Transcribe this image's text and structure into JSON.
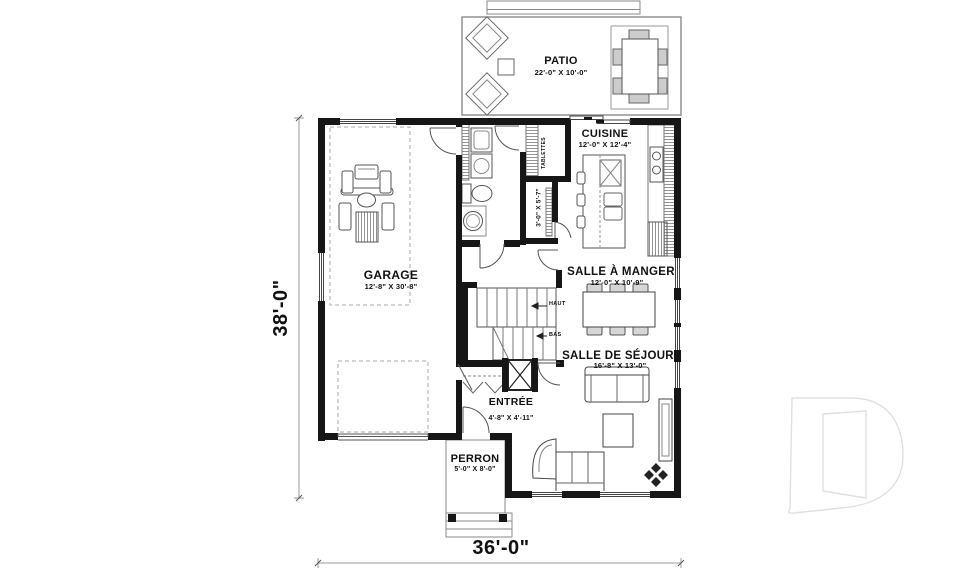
{
  "rooms": {
    "patio": {
      "name": "PATIO",
      "dims": "22'-0\" X 10'-0\""
    },
    "cuisine": {
      "name": "CUISINE",
      "dims": "12'-0\" X 12'-4\""
    },
    "garage": {
      "name": "GARAGE",
      "dims": "12'-8\" X 30'-8\""
    },
    "manger": {
      "name": "SALLE À MANGER",
      "dims": "12'-0\" X 10'-9\""
    },
    "sejour": {
      "name": "SALLE DE SÉJOUR",
      "dims": "16'-8\" X 13'-0\""
    },
    "entree": {
      "name": "ENTRÉE",
      "dims": "4'-8\" X 4'-11\""
    },
    "perron": {
      "name": "PERRON",
      "dims": "5'-0\" X 8'-0\""
    }
  },
  "annotations": {
    "tablettes": "TABLETTES",
    "pantry_dims": "3'-0\" X 5'-7\"",
    "stairs_up": "HAUT",
    "stairs_down": "BAS"
  },
  "overall_dimensions": {
    "height_label": "38'-0\"",
    "width_label": "36'-0\""
  },
  "branding": {
    "watermark_letter": "D"
  },
  "colors": {
    "wall": "#161616",
    "furniture_line": "#555555",
    "light_line": "#999999",
    "dimension_text": "#111111",
    "watermark": "#e0e0e0"
  }
}
